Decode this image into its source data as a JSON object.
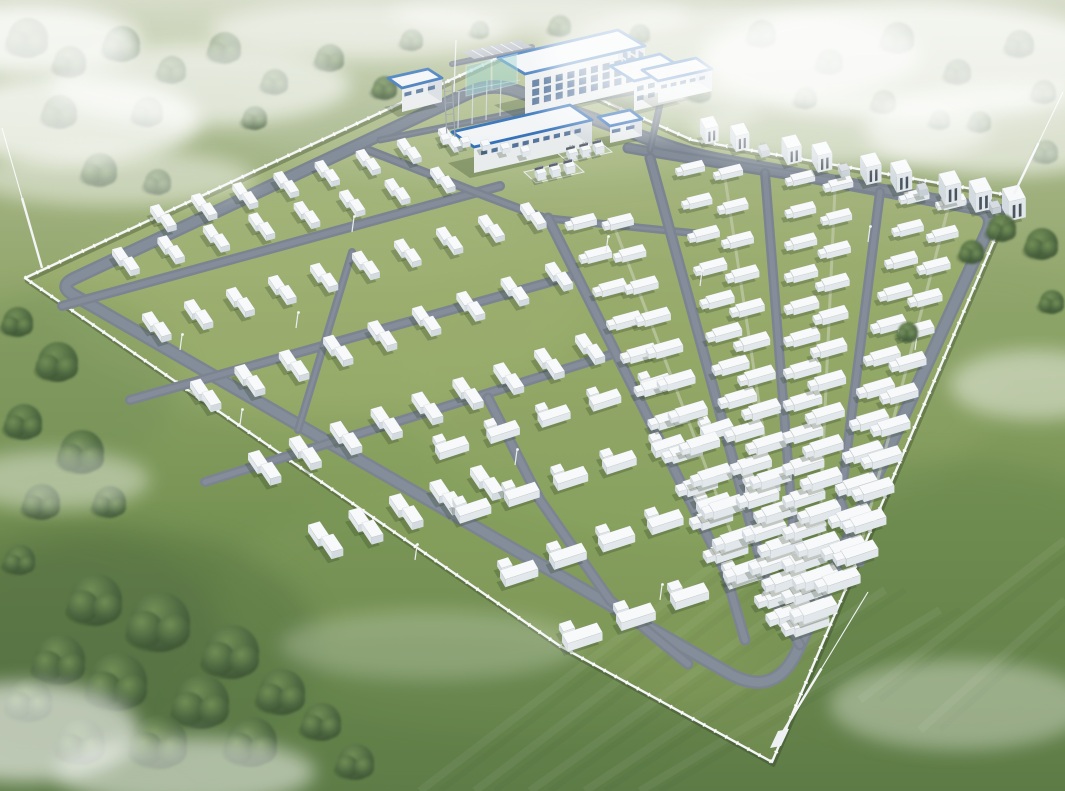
{
  "meta": {
    "title": "Aerial rendering of a battery energy storage power station",
    "description": "3D bird's-eye rendering: walled rectangular site with rows of white battery containers, gray loop roads, blue-trimmed substation buildings at the north side, grassland, trees and drifting fog"
  },
  "palette": {
    "grassTop": "#b9c3a3",
    "grassHi": "#a3b383",
    "grassMid": "#8ca263",
    "grassLow": "#73904f",
    "grassBottom": "#587741",
    "siteTint": "#aebf6f",
    "road": "#77818d",
    "roadLight": "#8b95a1",
    "roadCampus": "#8a939e",
    "wall": "#f4f6f7",
    "boxTop": "#f7f9fa",
    "boxFront": "#e2e7eb",
    "boxEnd": "#d2dae0",
    "shadow": "#24381c",
    "blueTrim": "#2a6ab5",
    "roof": "#f1f4f6",
    "bldgWall": "#e9eced",
    "bldgShade": "#d5dbe0",
    "window": "#3b5f8c",
    "windowSide": "#49719f",
    "panelTeal": "#8ed0cb",
    "steel": "#98a1aa",
    "slot": "#454f59",
    "transformerCap": "#57606b",
    "treeLight": "#6f8c52",
    "treeDark": "#3c5733",
    "treeEdge": "#2e4527",
    "fog": "#ffffff"
  },
  "scene": {
    "canvas": {
      "w": 1065,
      "h": 791
    },
    "vp": [
      810,
      740
    ],
    "grass_patches": [
      [
        500,
        120,
        260,
        60,
        "#b9c6a0",
        0.5
      ],
      [
        850,
        90,
        220,
        70,
        "#b4c29c",
        0.5
      ],
      [
        200,
        90,
        220,
        70,
        "#a9ba90",
        0.45
      ],
      [
        640,
        60,
        200,
        30,
        "#c3cba4",
        0.4
      ],
      [
        300,
        40,
        180,
        25,
        "#c0c9a2",
        0.35
      ],
      [
        320,
        300,
        260,
        120,
        "#9fb274",
        0.35
      ],
      [
        700,
        380,
        300,
        160,
        "#92a767",
        0.3
      ],
      [
        520,
        600,
        300,
        130,
        "#7e9a58",
        0.35
      ],
      [
        950,
        600,
        220,
        140,
        "#5f7f45",
        0.4
      ],
      [
        120,
        650,
        200,
        120,
        "#4e6a3b",
        0.45
      ],
      [
        60,
        380,
        120,
        90,
        "#6d8a52",
        0.4
      ],
      [
        980,
        330,
        120,
        70,
        "#86a065",
        0.35
      ],
      [
        420,
        720,
        240,
        80,
        "#5c7b44",
        0.4
      ],
      [
        40,
        640,
        180,
        120,
        "#3d5531",
        0.18
      ]
    ],
    "stripes": [
      [
        420,
        791,
        720,
        560
      ],
      [
        475,
        791,
        775,
        560
      ],
      [
        530,
        791,
        830,
        575
      ],
      [
        585,
        791,
        885,
        590
      ],
      [
        640,
        791,
        940,
        610
      ],
      [
        860,
        700,
        1065,
        540
      ],
      [
        920,
        730,
        1065,
        600
      ]
    ],
    "trees_back": [
      [
        28,
        38,
        20
      ],
      [
        70,
        62,
        16
      ],
      [
        122,
        44,
        18
      ],
      [
        172,
        70,
        14
      ],
      [
        225,
        48,
        16
      ],
      [
        275,
        82,
        13
      ],
      [
        330,
        58,
        14
      ],
      [
        385,
        88,
        12
      ],
      [
        60,
        112,
        17
      ],
      [
        148,
        112,
        15
      ],
      [
        255,
        118,
        12
      ],
      [
        412,
        40,
        11
      ],
      [
        100,
        170,
        17
      ],
      [
        158,
        182,
        13
      ],
      [
        480,
        30,
        9
      ],
      [
        560,
        26,
        11
      ],
      [
        600,
        44,
        9
      ],
      [
        640,
        34,
        10
      ],
      [
        700,
        92,
        11
      ],
      [
        762,
        34,
        14
      ],
      [
        830,
        62,
        13
      ],
      [
        898,
        38,
        16
      ],
      [
        958,
        72,
        13
      ],
      [
        1020,
        44,
        14
      ],
      [
        1044,
        92,
        12
      ],
      [
        884,
        102,
        12
      ],
      [
        806,
        98,
        11
      ],
      [
        980,
        122,
        11
      ],
      [
        1046,
        152,
        12
      ],
      [
        940,
        120,
        10
      ]
    ],
    "trees_front": [
      [
        18,
        322,
        15
      ],
      [
        58,
        362,
        20
      ],
      [
        24,
        422,
        18
      ],
      [
        82,
        452,
        22
      ],
      [
        42,
        502,
        18
      ],
      [
        110,
        502,
        16
      ],
      [
        20,
        560,
        15
      ],
      [
        96,
        600,
        26
      ],
      [
        160,
        622,
        30
      ],
      [
        232,
        652,
        27
      ],
      [
        118,
        682,
        29
      ],
      [
        202,
        702,
        27
      ],
      [
        60,
        660,
        25
      ],
      [
        282,
        692,
        23
      ],
      [
        160,
        742,
        27
      ],
      [
        252,
        742,
        25
      ],
      [
        82,
        742,
        23
      ],
      [
        322,
        722,
        19
      ],
      [
        356,
        762,
        18
      ],
      [
        30,
        700,
        22
      ],
      [
        1002,
        228,
        14
      ],
      [
        1042,
        244,
        16
      ],
      [
        1052,
        302,
        12
      ],
      [
        908,
        332,
        10
      ],
      [
        972,
        252,
        12
      ]
    ],
    "wall": [
      [
        25,
        278
      ],
      [
        502,
        56
      ],
      [
        692,
        140
      ],
      [
        1013,
        196
      ],
      [
        772,
        762
      ],
      [
        560,
        646
      ],
      [
        368,
        514
      ]
    ],
    "perimeter": {
      "pts": [
        [
          58,
          286
        ],
        [
          492,
          82
        ],
        [
          690,
          154
        ],
        [
          996,
          212
        ],
        [
          775,
          700
        ]
      ],
      "radii": [
        18,
        26,
        30,
        22,
        55
      ],
      "w": 13.5
    },
    "roads": [
      {
        "pts": [
          [
            62,
            306
          ],
          [
            500,
            186
          ]
        ],
        "w": 10
      },
      {
        "pts": [
          [
            130,
            400
          ],
          [
            575,
            275
          ]
        ],
        "w": 10
      },
      {
        "pts": [
          [
            205,
            482
          ],
          [
            610,
            355
          ]
        ],
        "w": 10
      },
      {
        "pts": [
          [
            352,
            252
          ],
          [
            298,
            430
          ]
        ],
        "w": 8
      },
      {
        "pts": [
          [
            488,
            398
          ],
          [
            540,
            500
          ],
          [
            610,
            600
          ],
          [
            688,
            664
          ]
        ],
        "w": 11
      },
      {
        "pts": [
          [
            628,
            148
          ],
          [
            1004,
            210
          ]
        ],
        "w": 11
      },
      {
        "pts": [
          [
            544,
            218
          ],
          [
            702,
            234
          ]
        ],
        "w": 8
      },
      {
        "pts": [
          [
            368,
            150
          ],
          [
            470,
            190
          ],
          [
            544,
            218
          ]
        ],
        "w": 9
      },
      {
        "pts": [
          [
            380,
            140
          ],
          [
            560,
            104
          ],
          [
            700,
            80
          ]
        ],
        "w": 7
      },
      {
        "pts": [
          [
            452,
            64
          ],
          [
            532,
            47
          ]
        ],
        "w": 6
      },
      {
        "pts": [
          [
            660,
            104
          ],
          [
            650,
            150
          ]
        ],
        "w": 7
      }
    ],
    "vp_roads": [
      {
        "top": [
          548,
          218
        ],
        "endY": 570,
        "tail": [
          [
            745,
            640
          ]
        ],
        "w": 11
      },
      {
        "top": [
          650,
          158
        ],
        "endY": 588,
        "tail": [
          [
            800,
            645
          ]
        ],
        "w": 11
      },
      {
        "top": [
          765,
          173
        ],
        "endY": 560,
        "tail": [
          [
            812,
            612
          ]
        ],
        "w": 10
      },
      {
        "top": [
          880,
          192
        ],
        "endY": 500,
        "tail": [
          [
            860,
            562
          ]
        ],
        "w": 10
      }
    ],
    "bands_pair": [
      {
        "from": [
          150,
          212
        ],
        "to": [
          438,
          134
        ],
        "n": 8
      },
      {
        "from": [
          112,
          255
        ],
        "to": [
          430,
          174
        ],
        "n": 8
      },
      {
        "from": [
          142,
          320
        ],
        "to": [
          520,
          210
        ],
        "n": 10
      },
      {
        "from": [
          190,
          388
        ],
        "to": [
          545,
          270
        ],
        "n": 9
      },
      {
        "from": [
          248,
          460
        ],
        "to": [
          575,
          342
        ],
        "n": 9
      },
      {
        "from": [
          308,
          532
        ],
        "to": [
          470,
          475
        ],
        "n": 5
      }
    ],
    "bands_longpair": [
      {
        "from": [
          435,
          452
        ],
        "to": [
          640,
          388
        ],
        "n": 5
      },
      {
        "from": [
          455,
          515
        ],
        "to": [
          700,
          434
        ],
        "n": 6
      },
      {
        "from": [
          500,
          578
        ],
        "to": [
          745,
          492
        ],
        "n": 6
      },
      {
        "from": [
          562,
          642
        ],
        "to": [
          778,
          560
        ],
        "n": 5
      }
    ],
    "columns": [
      {
        "top": [
          583,
          224
        ],
        "bot": 555,
        "n": 11
      },
      {
        "top": [
          620,
          224
        ],
        "bot": 575,
        "n": 12
      },
      {
        "top": [
          692,
          170
        ],
        "bot": 600,
        "n": 14
      },
      {
        "top": [
          730,
          174
        ],
        "bot": 618,
        "n": 14
      },
      {
        "top": [
          802,
          180
        ],
        "bot": 628,
        "n": 15
      },
      {
        "top": [
          840,
          186
        ],
        "bot": 615,
        "n": 14
      },
      {
        "top": [
          916,
          198
        ],
        "bot": 585,
        "n": 13
      },
      {
        "top": [
          953,
          204
        ],
        "bot": 558,
        "n": 12
      }
    ],
    "walkway_pairs": [
      [
        0,
        1
      ],
      [
        2,
        3
      ],
      [
        4,
        5
      ],
      [
        6,
        7
      ]
    ],
    "pcs_row": {
      "from": [
        700,
        134
      ],
      "to": [
        1002,
        208
      ],
      "offsets": [
        0,
        0.1,
        0.27,
        0.37,
        0.53,
        0.63,
        0.79,
        0.89,
        1.0
      ],
      "transformers": [
        0.185,
        0.45,
        0.71,
        0.95
      ]
    },
    "buildings": [
      {
        "name": "parking-lot",
        "type": "parking",
        "p": [
          [
            462,
            52
          ],
          [
            520,
            40
          ],
          [
            532,
            47
          ],
          [
            474,
            59
          ]
        ],
        "slots": 6
      },
      {
        "name": "main-office-building",
        "type": "prism",
        "p": [
          [
            498,
            100
          ],
          [
            618,
            72
          ],
          [
            645,
            88
          ],
          [
            525,
            116
          ]
        ],
        "h": 42,
        "win": {
          "rows": 3,
          "n": 9
        },
        "sideWin": {
          "rows": 3,
          "n": 3
        }
      },
      {
        "name": "office-east-wing",
        "type": "prism",
        "p": [
          [
            610,
            96
          ],
          [
            660,
            84
          ],
          [
            684,
            99
          ],
          [
            634,
            111
          ]
        ],
        "h": 30,
        "win": {
          "rows": 2,
          "n": 4
        }
      },
      {
        "name": "east-substation-hall",
        "type": "prism",
        "p": [
          [
            642,
            92
          ],
          [
            696,
            80
          ],
          [
            712,
            91
          ],
          [
            658,
            103
          ]
        ],
        "h": 22,
        "win": {
          "rows": 1,
          "n": 5
        }
      },
      {
        "name": "west-auxiliary-building",
        "type": "prism",
        "p": [
          [
            388,
            102
          ],
          [
            428,
            93
          ],
          [
            442,
            102
          ],
          [
            402,
            112
          ]
        ],
        "h": 24,
        "win": {
          "rows": 1,
          "n": 3
        }
      },
      {
        "name": "long-workshop-building",
        "type": "prism",
        "p": [
          [
            452,
            158
          ],
          [
            570,
            131
          ],
          [
            592,
            146
          ],
          [
            474,
            173
          ]
        ],
        "h": 26,
        "win": {
          "rows": 1,
          "n": 10
        }
      },
      {
        "name": "guard-kiosk-building",
        "type": "prism",
        "p": [
          [
            598,
            134
          ],
          [
            630,
            127
          ],
          [
            642,
            136
          ],
          [
            610,
            143
          ]
        ],
        "h": 17,
        "win": {
          "rows": 1,
          "n": 2
        }
      }
    ],
    "substation": {
      "panels": [
        [
          466,
          96
        ],
        [
          492,
          90
        ]
      ],
      "panelSize": [
        26,
        30
      ],
      "tower": [
        447,
        138,
        58
      ],
      "poles": [
        [
          458,
          128,
          36
        ],
        [
          472,
          124,
          40
        ],
        [
          486,
          120,
          40
        ],
        [
          500,
          116,
          36
        ]
      ],
      "bus": [
        [
          456,
          92
        ],
        [
          520,
          80
        ]
      ],
      "boxRow": {
        "from": [
          440,
          140
        ],
        "to": [
          520,
          152
        ],
        "n": 5
      }
    },
    "pads": [
      {
        "p": [
          [
            556,
            152
          ],
          [
            600,
            142
          ],
          [
            612,
            152
          ],
          [
            568,
            162
          ]
        ],
        "units": 3
      },
      {
        "p": [
          [
            524,
            172
          ],
          [
            572,
            161
          ],
          [
            584,
            172
          ],
          [
            536,
            183
          ]
        ],
        "units": 3
      }
    ],
    "masts": [
      {
        "from": [
          42,
          268
        ],
        "to": [
          2,
          128
        ],
        "base": false
      },
      {
        "from": [
          1014,
          194
        ],
        "to": [
          1063,
          92
        ],
        "base": false
      },
      {
        "from": [
          775,
          745
        ],
        "to": [
          868,
          592
        ],
        "base": true
      }
    ],
    "flagpole": [
      [
        454,
        92
      ],
      [
        456,
        40
      ]
    ],
    "light_poles": [
      [
        352,
        232
      ],
      [
        296,
        328
      ],
      [
        606,
        252
      ],
      [
        700,
        286
      ],
      [
        868,
        242
      ],
      [
        515,
        465
      ],
      [
        240,
        425
      ],
      [
        415,
        560
      ],
      [
        660,
        600
      ],
      [
        915,
        350
      ],
      [
        180,
        350
      ]
    ],
    "fog": [
      [
        70,
        120,
        130,
        45,
        0.75
      ],
      [
        200,
        85,
        150,
        40,
        0.6
      ],
      [
        30,
        40,
        110,
        35,
        0.8
      ],
      [
        360,
        30,
        150,
        28,
        0.55
      ],
      [
        540,
        14,
        150,
        22,
        0.5
      ],
      [
        730,
        55,
        190,
        50,
        0.65
      ],
      [
        910,
        60,
        210,
        60,
        0.75
      ],
      [
        1005,
        130,
        140,
        45,
        0.6
      ],
      [
        840,
        130,
        150,
        35,
        0.5
      ],
      [
        650,
        108,
        110,
        28,
        0.4
      ],
      [
        1035,
        385,
        85,
        35,
        0.45
      ],
      [
        55,
        480,
        95,
        30,
        0.4
      ],
      [
        25,
        732,
        115,
        50,
        0.6
      ],
      [
        185,
        772,
        130,
        35,
        0.5
      ],
      [
        115,
        178,
        140,
        28,
        0.45
      ],
      [
        960,
        705,
        130,
        45,
        0.35
      ],
      [
        430,
        645,
        150,
        35,
        0.22
      ]
    ]
  }
}
